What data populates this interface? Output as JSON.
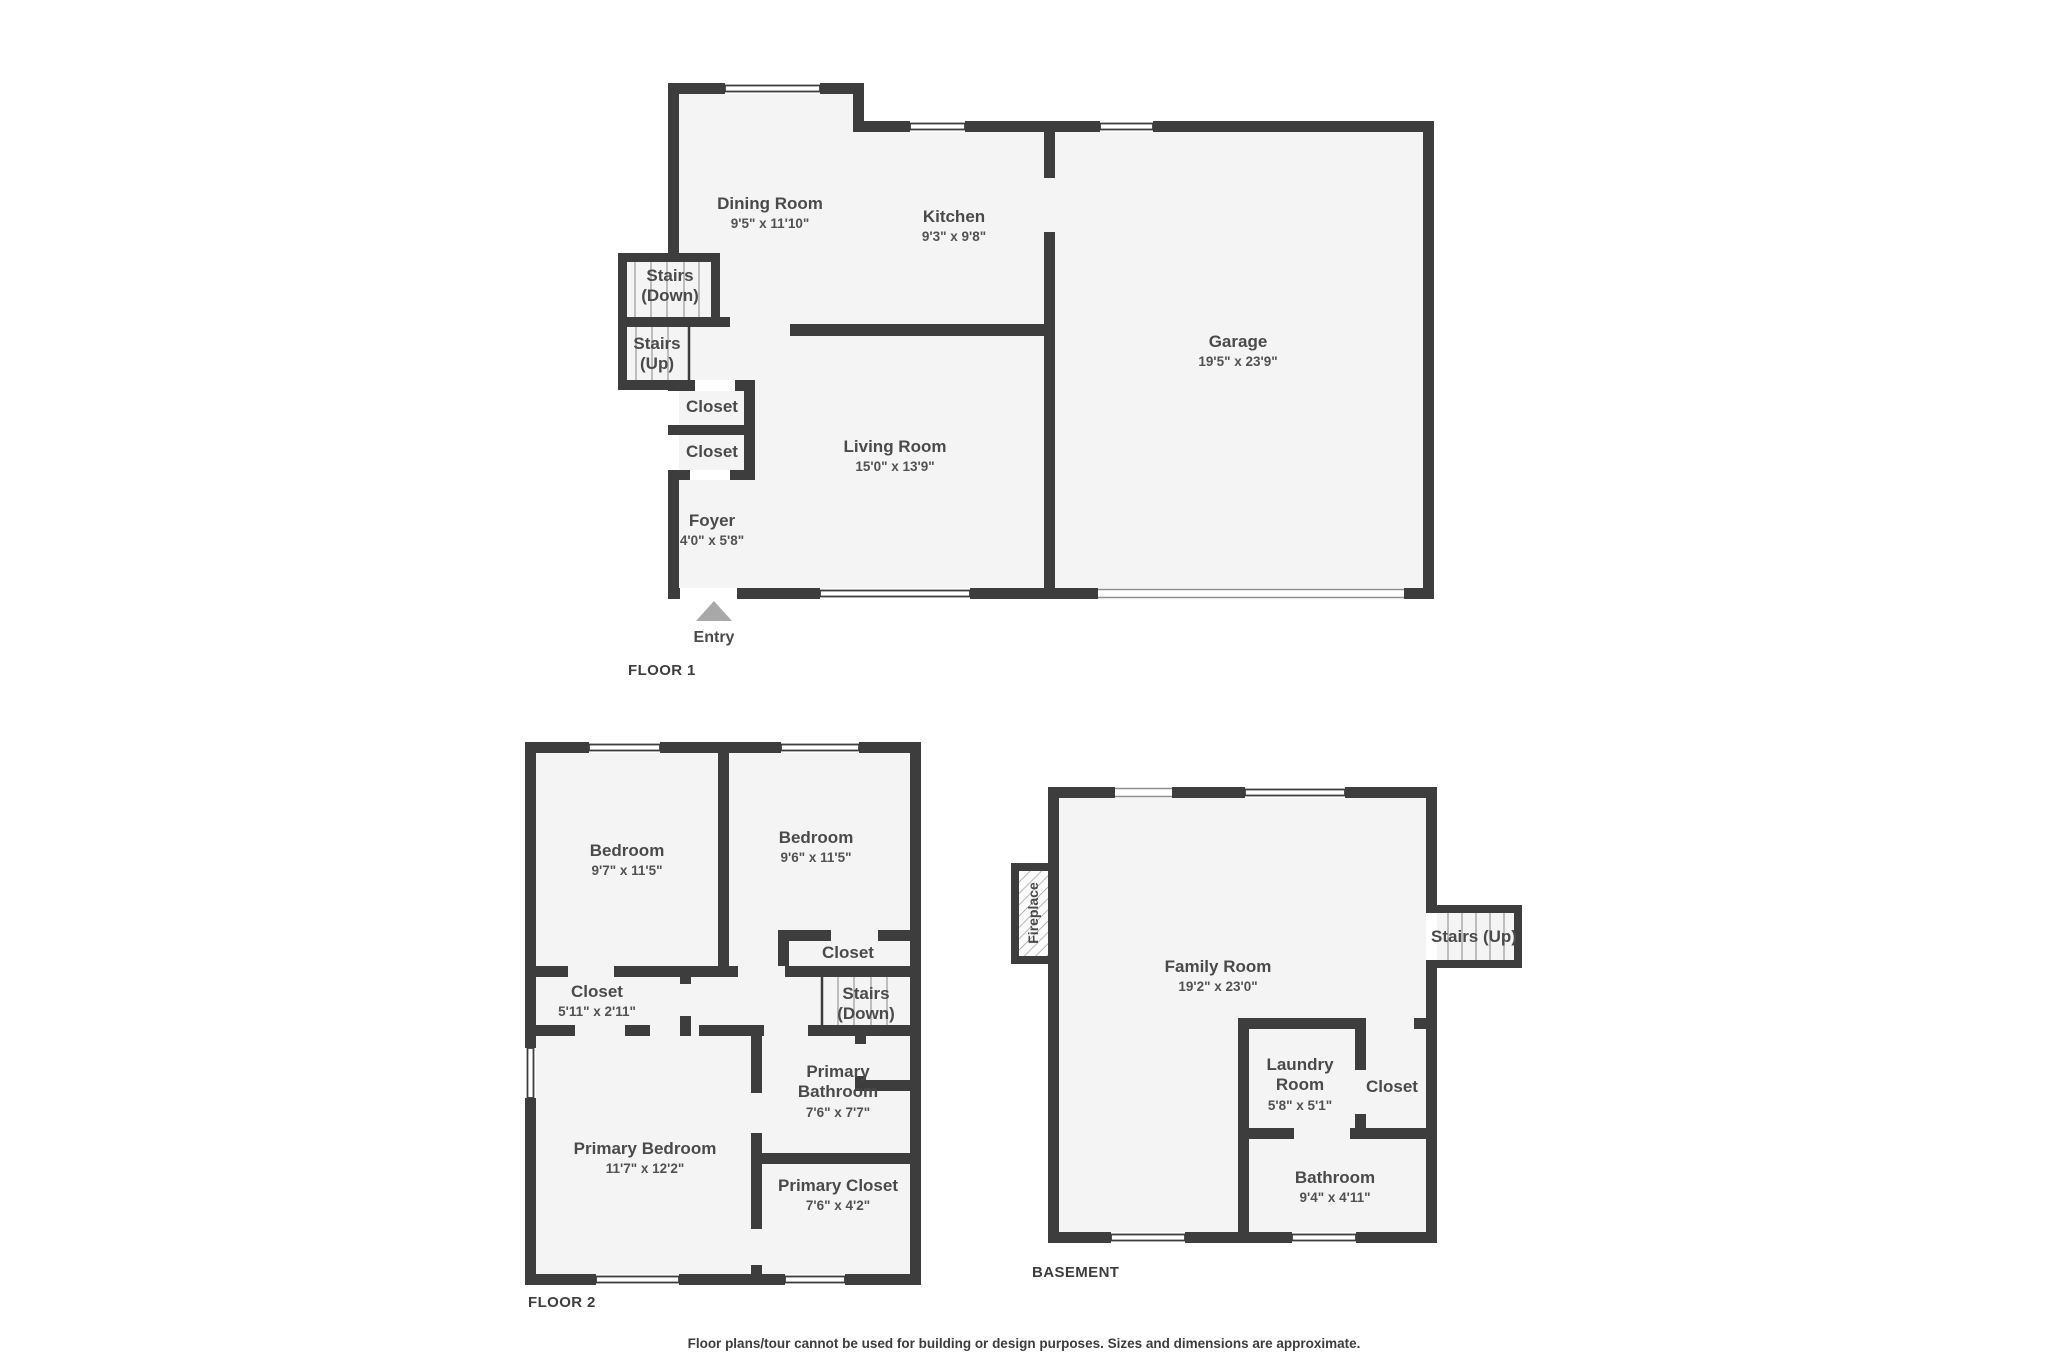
{
  "page": {
    "disclaimer": "Floor plans/tour cannot be used for building or design purposes. Sizes and dimensions are approximate.",
    "wall_color": "#3d3d3d",
    "room_fill_color": "#f4f4f4",
    "entry_arrow_color": "#a8a8a8"
  },
  "floor1": {
    "label": "FLOOR 1",
    "entry_label": "Entry",
    "rooms": {
      "dining": {
        "name": "Dining Room",
        "dims": "9'5\" x 11'10\""
      },
      "kitchen": {
        "name": "Kitchen",
        "dims": "9'3\" x 9'8\""
      },
      "garage": {
        "name": "Garage",
        "dims": "19'5\" x 23'9\""
      },
      "stairs_down": {
        "name": "Stairs (Down)"
      },
      "stairs_up": {
        "name": "Stairs (Up)"
      },
      "closet_a": {
        "name": "Closet"
      },
      "closet_b": {
        "name": "Closet"
      },
      "living": {
        "name": "Living Room",
        "dims": "15'0\" x 13'9\""
      },
      "foyer": {
        "name": "Foyer",
        "dims": "4'0\" x 5'8\""
      }
    }
  },
  "floor2": {
    "label": "FLOOR 2",
    "rooms": {
      "bedroom_a": {
        "name": "Bedroom",
        "dims": "9'7\" x 11'5\""
      },
      "bedroom_b": {
        "name": "Bedroom",
        "dims": "9'6\" x 11'5\""
      },
      "closet_tr": {
        "name": "Closet"
      },
      "closet_hall": {
        "name": "Closet",
        "dims": "5'11\" x 2'11\""
      },
      "stairs_down": {
        "name": "Stairs (Down)"
      },
      "primary_bedroom": {
        "name": "Primary Bedroom",
        "dims": "11'7\" x 12'2\""
      },
      "primary_bathroom": {
        "name": "Primary Bathroom",
        "dims": "7'6\" x 7'7\""
      },
      "primary_closet": {
        "name": "Primary Closet",
        "dims": "7'6\" x 4'2\""
      }
    }
  },
  "basement": {
    "label": "BASEMENT",
    "rooms": {
      "family": {
        "name": "Family Room",
        "dims": "19'2\" x 23'0\""
      },
      "laundry": {
        "name": "Laundry Room",
        "dims": "5'8\" x 5'1\""
      },
      "closet": {
        "name": "Closet"
      },
      "bathroom": {
        "name": "Bathroom",
        "dims": "9'4\" x 4'11\""
      },
      "stairs_up": {
        "name": "Stairs (Up)"
      },
      "fireplace": {
        "name": "Fireplace"
      }
    }
  }
}
